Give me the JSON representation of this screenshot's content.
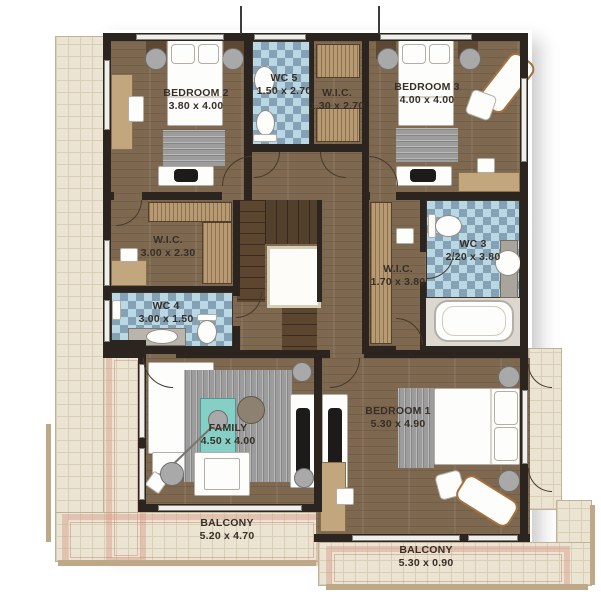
{
  "colors": {
    "wall": "#2b241f",
    "wood_floor": "#7e6850",
    "stair_wood": "#5d4630",
    "balcony_tile": "#ece4d3",
    "balcony_accent_pink": "#d69a86",
    "mosaic_tile_blue": "#a9cddd",
    "closet_wood": "#b79a72",
    "accent_teal": "#85cfc6",
    "label_text": "#372f26"
  },
  "rooms": {
    "bedroom2": {
      "name": "BEDROOM 2",
      "dims": "3.80 x 4.00"
    },
    "wc5": {
      "name": "WC 5",
      "dims": "1.50 x 2.70"
    },
    "wic_top": {
      "name": "W.I.C.",
      "dims": "1.30 x 2.70"
    },
    "bedroom3": {
      "name": "BEDROOM 3",
      "dims": "4.00 x 4.00"
    },
    "wic_left": {
      "name": "W.I.C.",
      "dims": "3.00 x 2.30"
    },
    "wc4": {
      "name": "WC 4",
      "dims": "3.00 x 1.50"
    },
    "wic_right": {
      "name": "W.I.C.",
      "dims": "1.70 x 3.80"
    },
    "wc3": {
      "name": "WC 3",
      "dims": "2.20 x 3.80"
    },
    "family": {
      "name": "FAMILY",
      "dims": "4.50 x 4.00"
    },
    "bedroom1": {
      "name": "BEDROOM 1",
      "dims": "5.30 x 4.90"
    },
    "balcony_left": {
      "name": "BALCONY",
      "dims": "5.20 x 4.70"
    },
    "balcony_bottom": {
      "name": "BALCONY",
      "dims": "5.30 x 0.90"
    }
  }
}
